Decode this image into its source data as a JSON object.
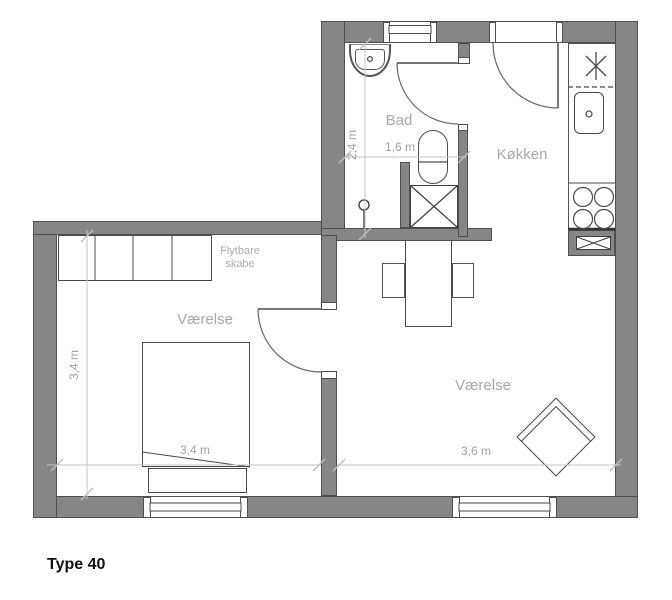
{
  "title": "Type 40",
  "rooms": {
    "bathroom": "Bad",
    "kitchen": "Køkken",
    "bedroom_left": "Værelse",
    "room_right": "Værelse"
  },
  "annotations": {
    "wardrobe_line1": "Flytbare",
    "wardrobe_line2": "skabe"
  },
  "dimensions": {
    "bathroom_depth": "2,4 m",
    "bathroom_width": "1,6 m",
    "bedroom_depth": "3,4 m",
    "bedroom_width": "3,4 m",
    "room_right_width": "3,6 m"
  },
  "colors": {
    "wall_fill": "#868686",
    "wall_outline": "#4f4f4f",
    "fixture_line": "#4a4a4a",
    "dimension_line": "#c6c6c6",
    "room_label_text": "#a8a8aa",
    "dimension_text": "#a2a2a2",
    "title_text": "#111111",
    "background": "#ffffff"
  }
}
